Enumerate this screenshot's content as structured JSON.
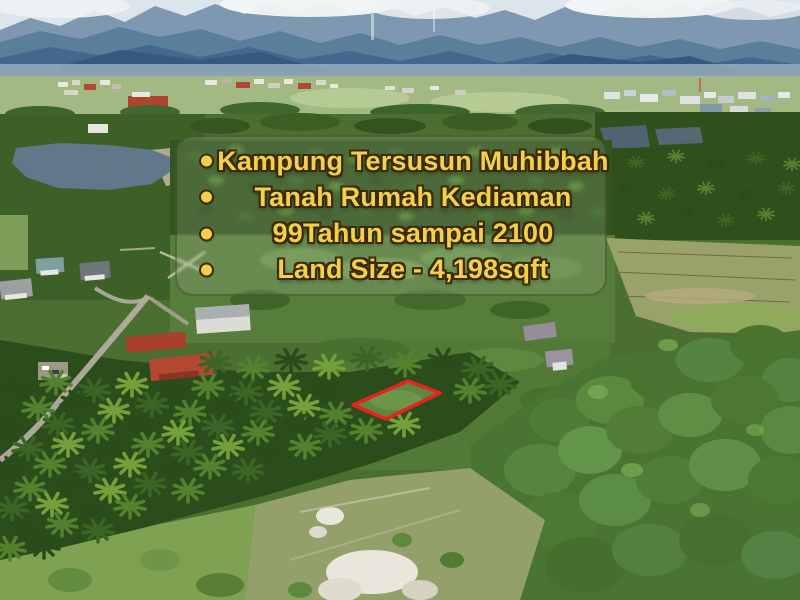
{
  "listing_overlay": {
    "items": [
      "Kampung Tersusun Muhibbah",
      "Tanah Rumah Kediaman",
      "99Tahun sampai 2100",
      "Land Size - 4,198sqft"
    ],
    "bullet_icon": "circle",
    "text_color": "#F2D04E",
    "outline_color": "#3A2A06",
    "panel_tint": "rgba(240,238,228,0.13)"
  },
  "plot_marker": {
    "color": "#E8231C"
  }
}
